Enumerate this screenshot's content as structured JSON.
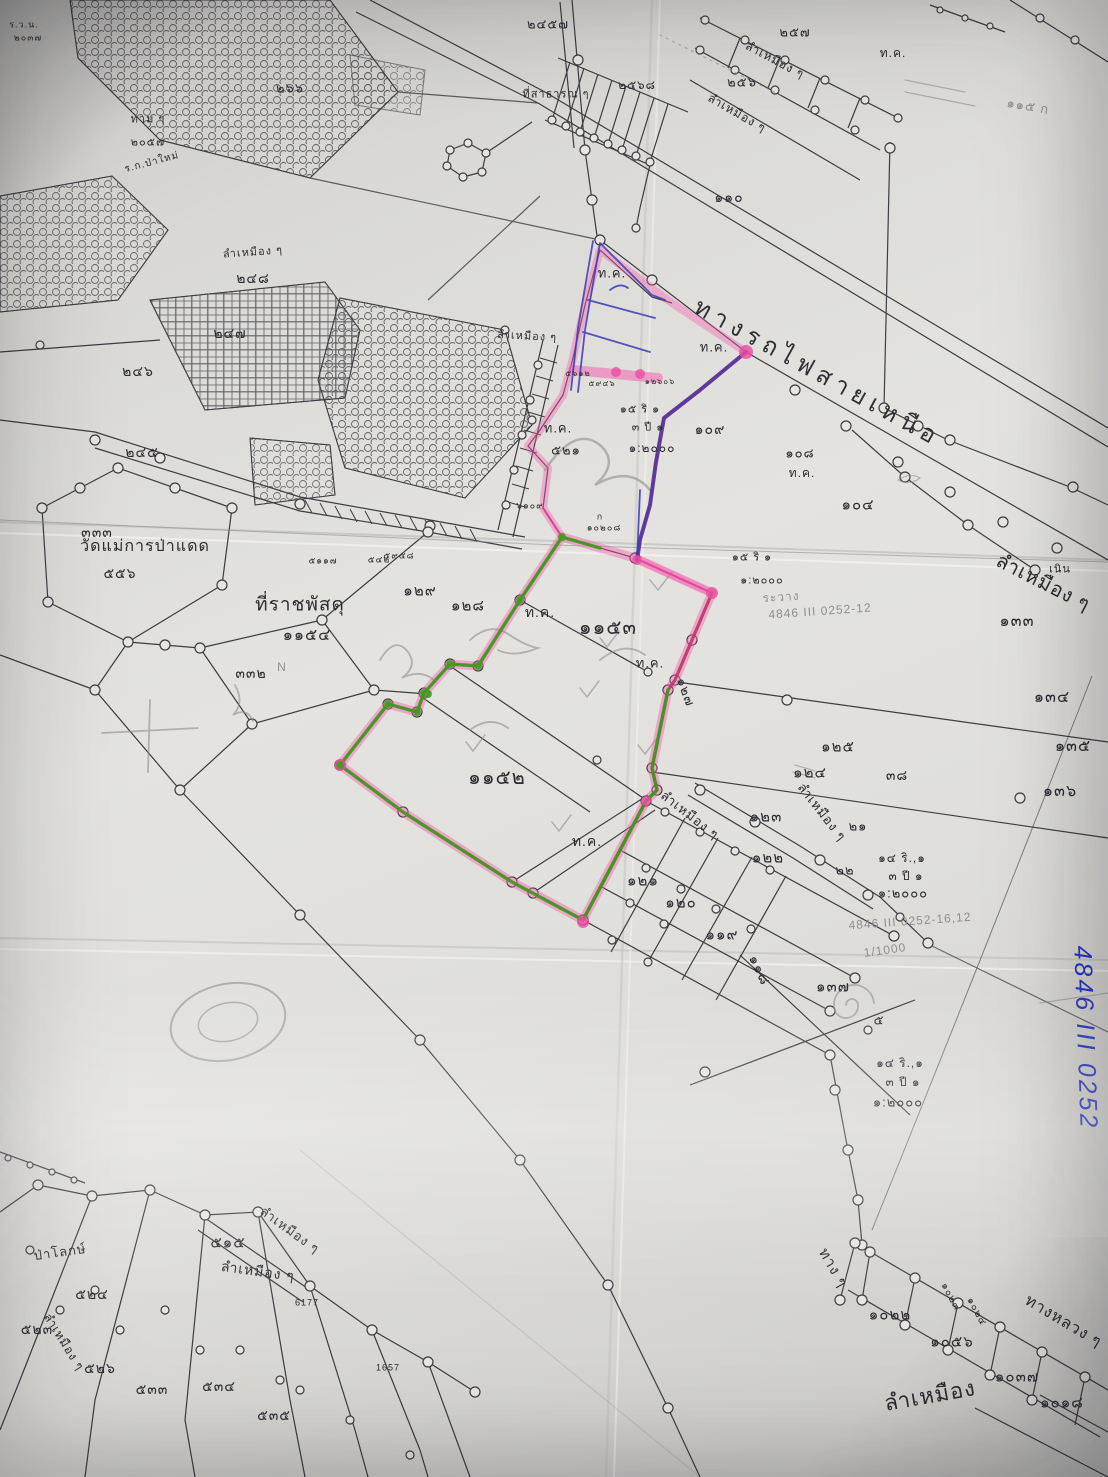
{
  "map": {
    "railway_label": "ทางรถไฟสายเหนือ",
    "sheet_code_vertical": "4846 III 0252",
    "highlight_colors": {
      "pink_highlighter": "#ee4da2",
      "green_highlighter": "#3f9a1f",
      "purple_pen": "#5f2a86",
      "blue_pen": "#3a3ab8",
      "blue_marker": "#2837c8",
      "dark_red_edge": "#7a3a22"
    },
    "labels": [
      {
        "t": "ลำเหมือง ๆ",
        "x": 1043,
        "y": 583,
        "s": 20,
        "r": 27
      },
      {
        "t": "๑๓๓",
        "x": 1017,
        "y": 622,
        "s": 16
      },
      {
        "t": "๑๓๔",
        "x": 1052,
        "y": 698,
        "s": 16
      },
      {
        "t": "๑๓๕",
        "x": 1073,
        "y": 747,
        "s": 16
      },
      {
        "t": "๑๓๖",
        "x": 1060,
        "y": 792,
        "s": 16
      },
      {
        "t": "๑๒๕",
        "x": 838,
        "y": 747,
        "s": 15
      },
      {
        "t": "๑๒๔",
        "x": 810,
        "y": 773,
        "s": 15
      },
      {
        "t": "๑๒๓",
        "x": 766,
        "y": 817,
        "s": 15
      },
      {
        "t": "๑๒๒",
        "x": 768,
        "y": 858,
        "s": 15
      },
      {
        "t": "๒๑",
        "x": 858,
        "y": 826,
        "s": 13
      },
      {
        "t": "๒๒",
        "x": 845,
        "y": 870,
        "s": 13
      },
      {
        "t": "๓๘",
        "x": 897,
        "y": 775,
        "s": 14
      },
      {
        "t": "ลำเหมือง ๆ",
        "x": 690,
        "y": 815,
        "s": 13,
        "r": 38
      },
      {
        "t": "ลำเหมือง ๆ",
        "x": 822,
        "y": 812,
        "s": 13,
        "r": 52
      },
      {
        "t": "ท.ค.",
        "x": 587,
        "y": 841,
        "s": 14
      },
      {
        "t": "ท.ค.",
        "x": 650,
        "y": 663,
        "s": 13
      },
      {
        "t": "ท.ค.",
        "x": 540,
        "y": 612,
        "s": 14
      },
      {
        "t": "๑๑๕๓",
        "x": 608,
        "y": 628,
        "s": 20
      },
      {
        "t": "๑๑๕๒",
        "x": 497,
        "y": 778,
        "s": 20
      },
      {
        "t": "๑๒๑",
        "x": 643,
        "y": 881,
        "s": 15
      },
      {
        "t": "๑๒๐",
        "x": 681,
        "y": 903,
        "s": 15
      },
      {
        "t": "๑๑๙",
        "x": 722,
        "y": 935,
        "s": 15
      },
      {
        "t": "๑๑๘",
        "x": 760,
        "y": 970,
        "s": 14,
        "r": 65
      },
      {
        "t": "๑๓๗",
        "x": 833,
        "y": 987,
        "s": 15
      },
      {
        "t": "๕",
        "x": 879,
        "y": 1020,
        "s": 13
      },
      {
        "t": "๑๔ ริ.,๑",
        "x": 900,
        "y": 1063,
        "s": 12
      },
      {
        "t": "๓ ปี ๑",
        "x": 903,
        "y": 1082,
        "s": 12
      },
      {
        "t": "๑:๒๐๐๐",
        "x": 898,
        "y": 1102,
        "s": 13
      },
      {
        "t": "4846 III 0252-16,12",
        "x": 910,
        "y": 921,
        "s": 12,
        "r": -4,
        "c": "pencil"
      },
      {
        "t": "1/1000",
        "x": 885,
        "y": 950,
        "s": 12,
        "r": -8,
        "c": "pencil"
      },
      {
        "t": "๑๔ ริ.,๑",
        "x": 902,
        "y": 858,
        "s": 12
      },
      {
        "t": "๓ ปี ๑",
        "x": 906,
        "y": 876,
        "s": 12
      },
      {
        "t": "๑:๒๐๐๐",
        "x": 903,
        "y": 893,
        "s": 13
      },
      {
        "t": "ระวาง",
        "x": 781,
        "y": 597,
        "s": 12,
        "r": -4,
        "c": "pencil"
      },
      {
        "t": "4846 III 0252-12",
        "x": 820,
        "y": 611,
        "s": 12,
        "r": -4,
        "c": "pencil"
      },
      {
        "t": "๑๕ ริ ๑",
        "x": 752,
        "y": 558,
        "s": 11
      },
      {
        "t": "๑:๒๐๐๐",
        "x": 762,
        "y": 581,
        "s": 11
      },
      {
        "t": "๑๕ ริ ๑",
        "x": 640,
        "y": 410,
        "s": 11
      },
      {
        "t": "๓ ปี ๑",
        "x": 648,
        "y": 428,
        "s": 11
      },
      {
        "t": "๑:๒๐๐๐",
        "x": 652,
        "y": 448,
        "s": 12
      },
      {
        "t": "๑๐๙",
        "x": 710,
        "y": 429,
        "s": 14
      },
      {
        "t": "๑๐๘",
        "x": 800,
        "y": 453,
        "s": 13
      },
      {
        "t": "ท.ค.",
        "x": 802,
        "y": 473,
        "s": 12
      },
      {
        "t": "๑๐๔",
        "x": 858,
        "y": 505,
        "s": 15
      },
      {
        "t": "เนิน",
        "x": 1060,
        "y": 570,
        "s": 11
      },
      {
        "t": "๑๒๗",
        "x": 686,
        "y": 692,
        "s": 13,
        "r": 70
      },
      {
        "t": "๑๒๙",
        "x": 420,
        "y": 591,
        "s": 15
      },
      {
        "t": "๑๒๘",
        "x": 468,
        "y": 606,
        "s": 15
      },
      {
        "t": "ท.ค.",
        "x": 612,
        "y": 273,
        "s": 13
      },
      {
        "t": "ท.ค.",
        "x": 714,
        "y": 347,
        "s": 13
      },
      {
        "t": "ท.ค.",
        "x": 558,
        "y": 428,
        "s": 13
      },
      {
        "t": "๕๒๑",
        "x": 566,
        "y": 450,
        "s": 13
      },
      {
        "t": "ที่ราชพัสดุ",
        "x": 300,
        "y": 605,
        "s": 19
      },
      {
        "t": "๑๑๕๔",
        "x": 307,
        "y": 636,
        "s": 16
      },
      {
        "t": "วัดแม่การป่าแดด",
        "x": 145,
        "y": 547,
        "s": 16
      },
      {
        "t": "๕๕๖",
        "x": 120,
        "y": 573,
        "s": 14
      },
      {
        "t": "๓๓๓",
        "x": 97,
        "y": 532,
        "s": 14
      },
      {
        "t": "๓๓๒",
        "x": 251,
        "y": 673,
        "s": 14
      },
      {
        "t": "N",
        "x": 282,
        "y": 667,
        "s": 12,
        "c": "pencil"
      },
      {
        "t": "ลำเหมือง ๆ",
        "x": 527,
        "y": 337,
        "s": 11,
        "r": 3
      },
      {
        "t": "ลำเหมือง ๆ",
        "x": 253,
        "y": 253,
        "s": 11,
        "r": -4
      },
      {
        "t": "๒๔๘",
        "x": 253,
        "y": 278,
        "s": 14
      },
      {
        "t": "๒๔๗",
        "x": 230,
        "y": 333,
        "s": 14
      },
      {
        "t": "๒๔๖",
        "x": 138,
        "y": 371,
        "s": 14
      },
      {
        "t": "๒๔๕",
        "x": 142,
        "y": 452,
        "s": 14
      },
      {
        "t": "๒๖๖",
        "x": 290,
        "y": 88,
        "s": 13
      },
      {
        "t": "ทาม ๆ",
        "x": 148,
        "y": 120,
        "s": 11
      },
      {
        "t": "๒๐๕๗",
        "x": 148,
        "y": 143,
        "s": 11
      },
      {
        "t": "ร.ก.ป่าใหม่",
        "x": 152,
        "y": 163,
        "s": 10,
        "r": -15
      },
      {
        "t": "ร.ว.น.",
        "x": 24,
        "y": 25,
        "s": 9
      },
      {
        "t": "๒๐๓๗",
        "x": 28,
        "y": 38,
        "s": 9
      },
      {
        "t": "๒๔๕๗",
        "x": 548,
        "y": 24,
        "s": 13
      },
      {
        "t": "ที่สาธารณ ๆ",
        "x": 556,
        "y": 95,
        "s": 11
      },
      {
        "t": "๒๕๖๘",
        "x": 637,
        "y": 85,
        "s": 12
      },
      {
        "t": "๒๕๖",
        "x": 742,
        "y": 82,
        "s": 13
      },
      {
        "t": "๒๕๗",
        "x": 795,
        "y": 32,
        "s": 13
      },
      {
        "t": "ลำเหมือง ๆ",
        "x": 775,
        "y": 60,
        "s": 12,
        "r": 28
      },
      {
        "t": "ลำเหมือง ๆ",
        "x": 737,
        "y": 113,
        "s": 12,
        "r": 30
      },
      {
        "t": "ท.ค.",
        "x": 893,
        "y": 53,
        "s": 12
      },
      {
        "t": "๑๑๕ ก",
        "x": 1028,
        "y": 106,
        "s": 13,
        "r": 10,
        "c": "pencil"
      },
      {
        "t": "๑๑๐",
        "x": 729,
        "y": 197,
        "s": 14
      },
      {
        "t": "ลำเหมือง",
        "x": 930,
        "y": 1396,
        "s": 22,
        "r": -10
      },
      {
        "t": "ทาง ๆ",
        "x": 833,
        "y": 1268,
        "s": 15,
        "r": 60
      },
      {
        "t": "ทางหลวง ๆ",
        "x": 1063,
        "y": 1322,
        "s": 16,
        "r": 31
      },
      {
        "t": "๑๐๒๒",
        "x": 890,
        "y": 1315,
        "s": 15
      },
      {
        "t": "๑๐๕๖",
        "x": 952,
        "y": 1342,
        "s": 15
      },
      {
        "t": "๑๐๓๗",
        "x": 1017,
        "y": 1377,
        "s": 15
      },
      {
        "t": "๑๐๑๘",
        "x": 1062,
        "y": 1403,
        "s": 15
      },
      {
        "t": "๑๐๒๓",
        "x": 950,
        "y": 1297,
        "s": 10,
        "r": 62
      },
      {
        "t": "๑๐๒๔",
        "x": 976,
        "y": 1312,
        "s": 10,
        "r": 62
      },
      {
        "t": "๕๑๕",
        "x": 228,
        "y": 1243,
        "s": 15
      },
      {
        "t": "๕๒๔",
        "x": 92,
        "y": 1294,
        "s": 14
      },
      {
        "t": "๕๒๓",
        "x": 37,
        "y": 1329,
        "s": 14
      },
      {
        "t": "๕๒๖",
        "x": 100,
        "y": 1368,
        "s": 14
      },
      {
        "t": "๕๓๓",
        "x": 152,
        "y": 1389,
        "s": 14
      },
      {
        "t": "๕๓๔",
        "x": 219,
        "y": 1386,
        "s": 14
      },
      {
        "t": "๕๓๕",
        "x": 274,
        "y": 1415,
        "s": 14
      },
      {
        "t": "ลำเหมือง ๆ",
        "x": 290,
        "y": 1230,
        "s": 13,
        "r": 36
      },
      {
        "t": "ลำเหมือง ๆ",
        "x": 258,
        "y": 1271,
        "s": 14,
        "r": 8
      },
      {
        "t": "ลำเหมือง ๆ",
        "x": 64,
        "y": 1342,
        "s": 12,
        "r": 58
      },
      {
        "t": "ป่าโลกษ์",
        "x": 60,
        "y": 1252,
        "s": 13,
        "r": -8
      },
      {
        "t": "6177",
        "x": 307,
        "y": 1303,
        "s": 9
      },
      {
        "t": "1657",
        "x": 388,
        "y": 1368,
        "s": 9
      },
      {
        "t": "๖๑๐๙",
        "x": 530,
        "y": 506,
        "s": 9
      },
      {
        "t": "ก",
        "x": 600,
        "y": 517,
        "s": 9
      },
      {
        "t": "๑๐๒๐๘",
        "x": 604,
        "y": 528,
        "s": 9
      },
      {
        "t": "๕๖๑๒",
        "x": 578,
        "y": 374,
        "s": 8
      },
      {
        "t": "๕๙๔๖",
        "x": 602,
        "y": 384,
        "s": 8
      },
      {
        "t": "๑๒๖๐๖",
        "x": 660,
        "y": 382,
        "s": 8
      },
      {
        "t": "๕๑๑๗",
        "x": 323,
        "y": 561,
        "s": 9
      },
      {
        "t": "๕๔๒",
        "x": 379,
        "y": 560,
        "s": 9
      },
      {
        "t": "๕๙๔๘",
        "x": 399,
        "y": 556,
        "s": 9
      }
    ]
  }
}
